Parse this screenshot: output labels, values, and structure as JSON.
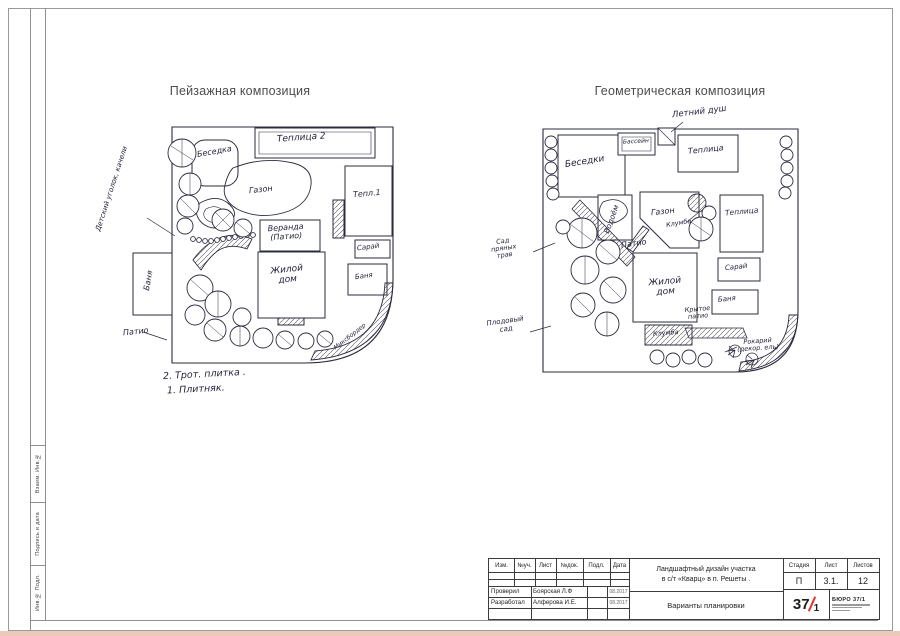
{
  "sheet": {
    "left_plan_title": "Пейзажная композиция",
    "right_plan_title": "Геометрическая композиция"
  },
  "left_plan": {
    "labels": {
      "side_note": "Детский уголок, качели",
      "besedka": "Беседка",
      "teplitsa2": "Теплица 2",
      "gazon": "Газон",
      "tepl1": "Тепл.1",
      "veranda_line1": "Веранда",
      "veranda_line2": "(Патио)",
      "saray": "Сарай",
      "dom_line1": "Жилой",
      "dom_line2": "дом",
      "banya_right": "Баня",
      "banya_left": "Баня",
      "patio": "Патио",
      "mixborder": "Миксбордер"
    },
    "notes": {
      "note1": "2. Трот. плитка .",
      "note2": "1. Плитняк."
    }
  },
  "right_plan": {
    "labels": {
      "letniy_dush": "Летний душ",
      "bassein": "Бассейн",
      "teplitsa_top": "Теплица",
      "besedki": "Беседки",
      "vodoem": "Водоём",
      "gazon": "Газон",
      "klumba_arrow": "Клумба",
      "teplitsa_right": "Теплица",
      "saray": "Сарай",
      "banya": "Баня",
      "dom_line1": "Жилой",
      "dom_line2": "дом",
      "patio": "Патио",
      "krytoe_line1": "Крытое",
      "krytoe_line2": "патио",
      "klumba": "Клумба",
      "sad_line1": "Сад",
      "sad_line2": "пряных",
      "sad_line3": "трав",
      "plodovy_line1": "Плодовый",
      "plodovy_line2": "сад",
      "rokariy_line1": "Рокарий",
      "rokariy_line2": "(декор. ель)"
    }
  },
  "stamps": {
    "s1": "Взаим. Инв.№",
    "s2": "Подпись и дата",
    "s3": "Инв.№ Подл."
  },
  "title_block": {
    "headers": {
      "izm": "Изм.",
      "uch": "№уч.",
      "list": "Лист",
      "dok": "№док.",
      "podl": "Подл.",
      "data": "Дата"
    },
    "rows": [
      {
        "role": "Проверил",
        "name": "Боярская Л.Ф",
        "date": "08.2017"
      },
      {
        "role": "Разработал",
        "name": "Алферова И.Е.",
        "date": "08.2017"
      }
    ],
    "project_line1": "Ландшафтный дизайн участка",
    "project_line2": "в с/т «Кварц» в п. Решеты .",
    "sheet_name": "Варианты планировки",
    "stage_label": "Стадия",
    "stage_value": "П",
    "sheet_label": "Лист",
    "sheet_value": "3.1.",
    "sheets_label": "Листов",
    "sheets_value": "12",
    "logo_num": "37",
    "logo_den": "1",
    "bureau": "БЮРО 37/1"
  },
  "colors": {
    "ink": "#2b2b3e",
    "accent_red": "#e03a2f"
  }
}
